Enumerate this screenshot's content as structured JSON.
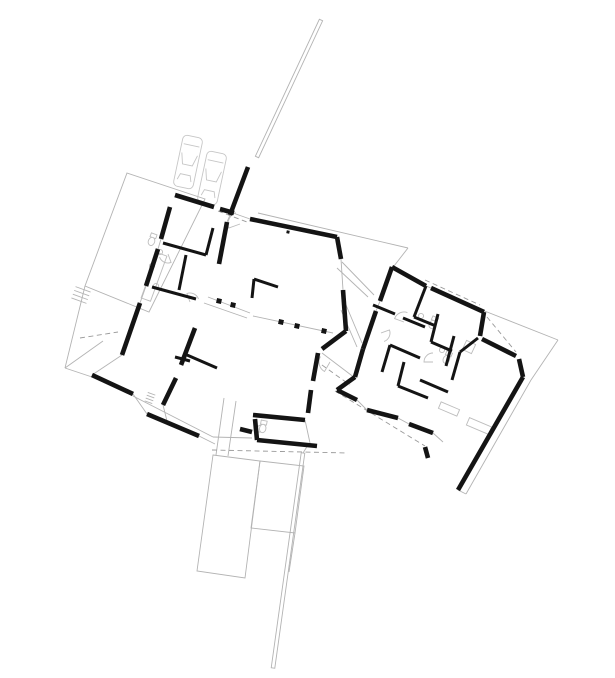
{
  "canvas": {
    "width": 615,
    "height": 678,
    "background": "#ffffff"
  },
  "colors": {
    "wall": "#141414",
    "partition": "#141414",
    "site_line": "#b3b3b3",
    "dashed_line": "#9a9a9a",
    "fixture": "#bdbdbd",
    "car": "#c6c6c6",
    "column": "#141414"
  },
  "stroke_widths": {
    "wall": 4.6,
    "partition": 3.0,
    "thin": 0.9,
    "dashed": 0.9
  },
  "dash_pattern": "5,3.5",
  "layers": {
    "exterior_walls": [
      [
        175,
        195,
        214,
        207
      ],
      [
        220,
        209,
        234,
        213
      ],
      [
        170,
        207,
        161,
        239
      ],
      [
        158,
        249,
        146,
        286
      ],
      [
        140,
        303,
        122,
        355
      ],
      [
        92,
        375,
        133,
        394
      ],
      [
        147,
        414,
        199,
        436
      ],
      [
        248,
        167,
        230,
        215
      ],
      [
        227,
        222,
        219,
        264
      ],
      [
        250,
        219,
        337,
        237
      ],
      [
        337,
        237,
        341,
        259
      ],
      [
        343,
        290,
        346,
        331
      ],
      [
        346,
        331,
        322,
        349
      ],
      [
        318,
        353,
        313,
        381
      ],
      [
        311,
        390,
        308,
        413
      ],
      [
        253,
        415,
        305,
        420
      ],
      [
        255,
        419,
        257,
        440
      ],
      [
        257,
        440,
        317,
        446
      ],
      [
        240,
        429,
        252,
        432
      ],
      [
        195,
        328,
        181,
        365
      ],
      [
        176,
        378,
        163,
        405
      ],
      [
        392,
        267,
        426,
        286
      ],
      [
        431,
        288,
        484,
        312
      ],
      [
        484,
        312,
        480,
        336
      ],
      [
        482,
        339,
        516,
        356
      ],
      [
        519,
        359,
        523,
        377
      ],
      [
        523,
        377,
        458,
        490
      ],
      [
        392,
        267,
        380,
        301
      ],
      [
        376,
        311,
        363,
        349
      ],
      [
        363,
        349,
        355,
        377
      ],
      [
        355,
        377,
        337,
        390
      ],
      [
        337,
        390,
        357,
        400
      ],
      [
        367,
        410,
        398,
        418
      ],
      [
        409,
        424,
        433,
        433
      ],
      [
        425,
        447,
        428,
        458
      ]
    ],
    "interior_partitions": [
      [
        163,
        243,
        206,
        255
      ],
      [
        206,
        255,
        213,
        228
      ],
      [
        152,
        287,
        196,
        299
      ],
      [
        186,
        255,
        179,
        290
      ],
      [
        187,
        355,
        217,
        368
      ],
      [
        175,
        357,
        190,
        361
      ],
      [
        254,
        279,
        278,
        287
      ],
      [
        254,
        279,
        252,
        298
      ],
      [
        426,
        286,
        414,
        317
      ],
      [
        373,
        305,
        395,
        314
      ],
      [
        403,
        318,
        425,
        327
      ],
      [
        414,
        317,
        436,
        326
      ],
      [
        438,
        314,
        431,
        342
      ],
      [
        431,
        342,
        452,
        351
      ],
      [
        454,
        336,
        446,
        366
      ],
      [
        478,
        338,
        460,
        352
      ],
      [
        460,
        352,
        452,
        380
      ],
      [
        390,
        345,
        420,
        358
      ],
      [
        390,
        345,
        382,
        372
      ],
      [
        404,
        362,
        398,
        386
      ],
      [
        420,
        380,
        448,
        392
      ],
      [
        398,
        386,
        428,
        398
      ]
    ],
    "site_lines": [
      [
        85,
        286,
        65,
        368
      ],
      [
        65,
        368,
        103,
        341
      ],
      [
        65,
        368,
        92,
        377
      ],
      [
        133,
        394,
        147,
        414
      ],
      [
        199,
        436,
        215,
        444
      ],
      [
        341,
        259,
        343,
        290
      ],
      [
        233,
        213,
        250,
        219
      ],
      [
        230,
        215,
        227,
        222
      ],
      [
        161,
        239,
        158,
        249
      ],
      [
        146,
        286,
        140,
        303
      ],
      [
        122,
        355,
        92,
        375
      ],
      [
        258,
        213,
        408,
        248
      ],
      [
        408,
        248,
        394,
        266
      ],
      [
        482,
        310,
        558,
        340
      ],
      [
        558,
        340,
        531,
        380
      ],
      [
        531,
        380,
        466,
        494
      ],
      [
        466,
        494,
        458,
        490
      ],
      [
        346,
        305,
        362,
        343
      ],
      [
        341,
        310,
        357,
        347
      ],
      [
        342,
        262,
        374,
        295
      ],
      [
        337,
        268,
        368,
        297
      ],
      [
        208,
        297,
        250,
        313
      ],
      [
        204,
        303,
        247,
        318
      ],
      [
        322,
        353,
        355,
        378
      ],
      [
        308,
        445,
        303,
        453
      ],
      [
        295,
        533,
        289,
        572
      ],
      [
        253,
        316,
        333,
        333
      ],
      [
        163,
        405,
        168,
        425
      ],
      [
        133,
        396,
        213,
        437
      ],
      [
        213,
        437,
        252,
        438
      ],
      [
        224,
        398,
        216,
        455
      ],
      [
        236,
        401,
        228,
        456
      ],
      [
        305,
        420,
        310,
        443
      ],
      [
        380,
        301,
        376,
        311
      ],
      [
        426,
        286,
        431,
        288
      ],
      [
        398,
        418,
        409,
        424
      ],
      [
        433,
        433,
        443,
        442
      ],
      [
        357,
        400,
        367,
        410
      ]
    ],
    "dashed_lines": [
      [
        218,
        211,
        247,
        222
      ],
      [
        80,
        338,
        118,
        332
      ],
      [
        212,
        450,
        348,
        453
      ],
      [
        335,
        391,
        425,
        446
      ],
      [
        425,
        280,
        480,
        305
      ],
      [
        487,
        317,
        516,
        352
      ],
      [
        315,
        360,
        350,
        385
      ]
    ],
    "polygons": [
      {
        "name": "carport-outline",
        "points": [
          [
            127,
            173
          ],
          [
            205,
            199
          ],
          [
            149,
            312
          ],
          [
            85,
            286
          ]
        ]
      },
      {
        "name": "terrace-upper",
        "points": [
          [
            213,
            455
          ],
          [
            260,
            461
          ],
          [
            245,
            578
          ],
          [
            197,
            571
          ]
        ]
      },
      {
        "name": "terrace-lower",
        "points": [
          [
            260,
            461
          ],
          [
            304,
            466
          ],
          [
            295,
            533
          ],
          [
            251,
            528
          ]
        ]
      }
    ],
    "boundary_strips": [
      {
        "name": "boundary-strip-north",
        "x1": 321,
        "y1": 20,
        "x2": 257,
        "y2": 157,
        "w": 3.6
      },
      {
        "name": "boundary-strip-south",
        "x1": 303,
        "y1": 453,
        "x2": 273,
        "y2": 668,
        "w": 3.6
      }
    ],
    "columns": [
      [
        281,
        322,
        5
      ],
      [
        297,
        326,
        5
      ],
      [
        324,
        331,
        5
      ],
      [
        219,
        301,
        5
      ],
      [
        233,
        305,
        5
      ],
      [
        288,
        232,
        3
      ]
    ],
    "cars": [
      {
        "cx": 188,
        "cy": 162,
        "rot": 12
      },
      {
        "cx": 212,
        "cy": 178,
        "rot": 12
      }
    ],
    "door_arcs": [
      {
        "cx": 240,
        "cy": 224,
        "r": 12,
        "a0": 160,
        "a1": 250
      },
      {
        "cx": 404,
        "cy": 322,
        "r": 10,
        "a0": 200,
        "a1": 290
      },
      {
        "cx": 381,
        "cy": 333,
        "r": 9,
        "a0": -20,
        "a1": 70
      },
      {
        "cx": 433,
        "cy": 362,
        "r": 9,
        "a0": 180,
        "a1": 270
      },
      {
        "cx": 168,
        "cy": 254,
        "r": 9,
        "a0": 70,
        "a1": 160
      },
      {
        "cx": 190,
        "cy": 302,
        "r": 9,
        "a0": 250,
        "a1": 340
      },
      {
        "cx": 330,
        "cy": 362,
        "r": 11,
        "a0": 120,
        "a1": 210
      },
      {
        "cx": 262,
        "cy": 432,
        "r": 7,
        "a0": 180,
        "a1": 270
      }
    ],
    "toilets": [
      [
        433,
        323,
        25
      ],
      [
        447,
        358,
        25
      ],
      [
        152,
        240,
        20
      ],
      [
        263,
        427,
        11
      ]
    ],
    "sink_circles": [
      [
        421,
        316
      ],
      [
        442,
        350
      ],
      [
        160,
        252
      ],
      [
        152,
        266
      ],
      [
        156,
        286
      ]
    ],
    "fixture_rects": [
      {
        "name": "shower",
        "cx": 469,
        "cy": 347,
        "rot": 25,
        "w": 10,
        "h": 10
      },
      {
        "name": "kitchen-counter",
        "cx": 154,
        "cy": 277,
        "rot": 20,
        "w": 10,
        "h": 48
      },
      {
        "name": "wardrobe-1",
        "cx": 479,
        "cy": 426,
        "rot": 23,
        "w": 24,
        "h": 8
      },
      {
        "name": "wardrobe-2",
        "cx": 449,
        "cy": 409,
        "rot": 23,
        "w": 20,
        "h": 7
      }
    ],
    "hatches": [
      {
        "name": "entry-steps-hatch",
        "cx": 81,
        "cy": 295,
        "rot": 20,
        "len": 16,
        "n": 4,
        "gap": 4
      },
      {
        "name": "sill-hatch",
        "cx": 150,
        "cy": 398,
        "rot": 20,
        "len": 8,
        "n": 4,
        "gap": 3
      }
    ]
  }
}
